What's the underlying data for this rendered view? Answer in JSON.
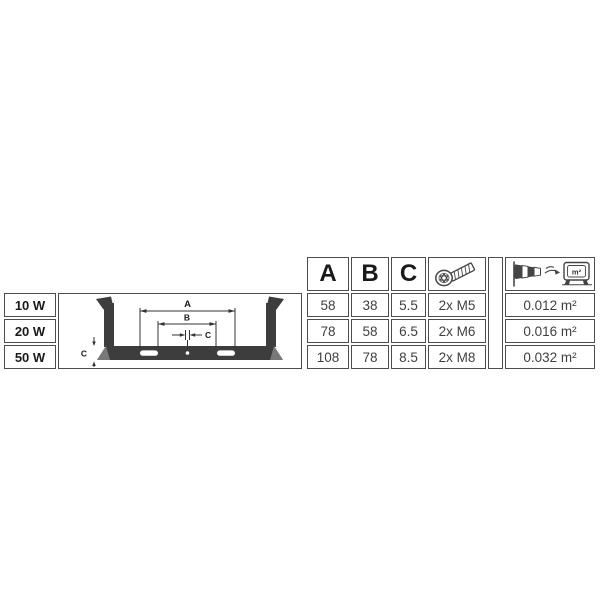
{
  "colors": {
    "table_border": "#4d4d4d",
    "bracket_fill": "#3d3d3d",
    "dimension_line": "#333333",
    "text_dark": "#1a1a1a",
    "text_value": "#3f3f3f"
  },
  "spec_table": {
    "header": {
      "col_a": "A",
      "col_b": "B",
      "col_c": "C",
      "screw_icon": "socket-screw-icon",
      "wind_icon": "windsock-wind-load-area-icon",
      "wind_icon_unit": "m²"
    },
    "rows": [
      {
        "wattage": "10 W",
        "a": "58",
        "b": "38",
        "c": "5.5",
        "screws": "2x M5",
        "wind_load_area": "0.012 m²"
      },
      {
        "wattage": "20 W",
        "a": "78",
        "b": "58",
        "c": "6.5",
        "screws": "2x M6",
        "wind_load_area": "0.016 m²"
      },
      {
        "wattage": "50 W",
        "a": "108",
        "b": "78",
        "c": "8.5",
        "screws": "2x M8",
        "wind_load_area": "0.032 m²"
      }
    ]
  },
  "diagram": {
    "dim_a_label": "A",
    "dim_b_label": "B",
    "dim_c_hole_label": "C",
    "dim_c_thickness_label": "C"
  }
}
